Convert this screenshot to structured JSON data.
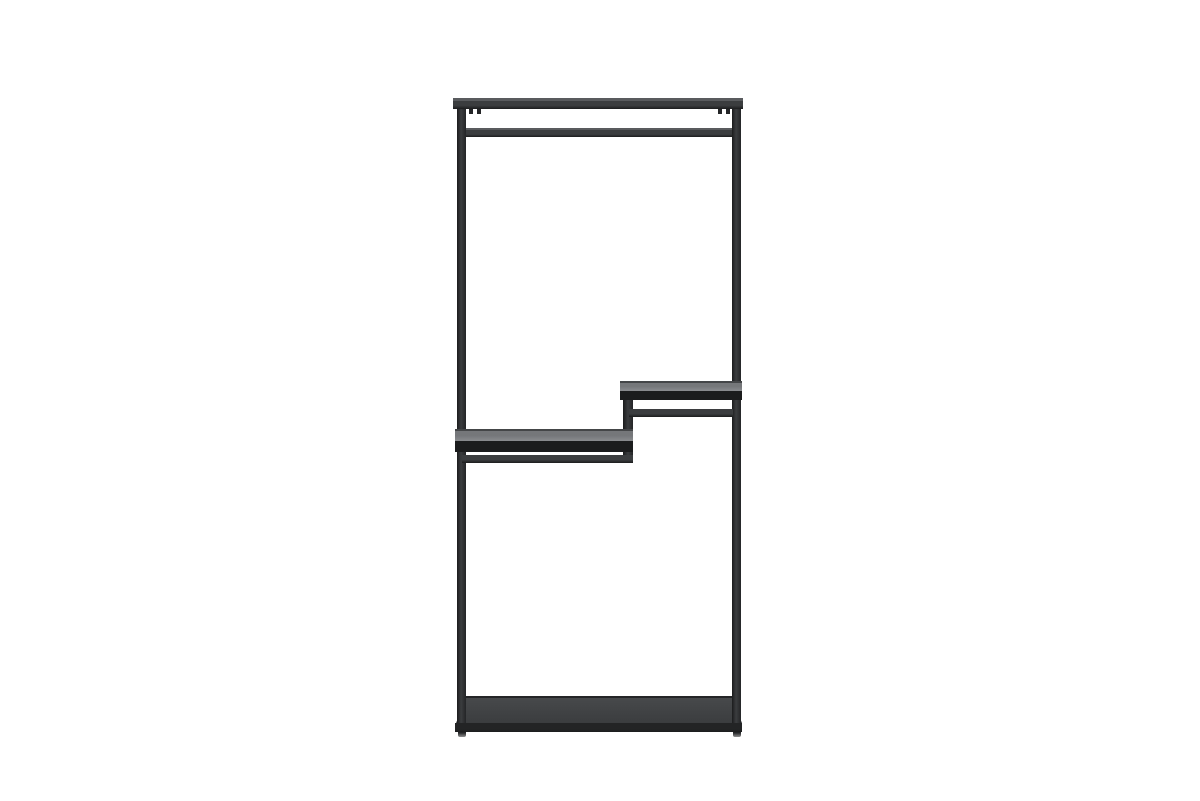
{
  "image": {
    "type": "product-photo",
    "subject": "black metal open clothes rack with hanging rail, two stepped shelves and base shelf",
    "orientation": "front view on plain white background"
  },
  "colors": {
    "background": "#ffffff",
    "frame": "#3b3d3f",
    "frame_dark": "#242527",
    "frame_edge": "#1b1c1d",
    "frame_highlight": "#595b5e",
    "shelf_top": "#75777a",
    "shelf_top_light": "#8a8c8f",
    "shelf_top_edge": "#444648",
    "shelf_lip": "#1b1c1d",
    "base_top": "#47494b",
    "base_top_dark": "#3b3d3f",
    "base_lip": "#232425",
    "foot": "#8f8f8f"
  }
}
